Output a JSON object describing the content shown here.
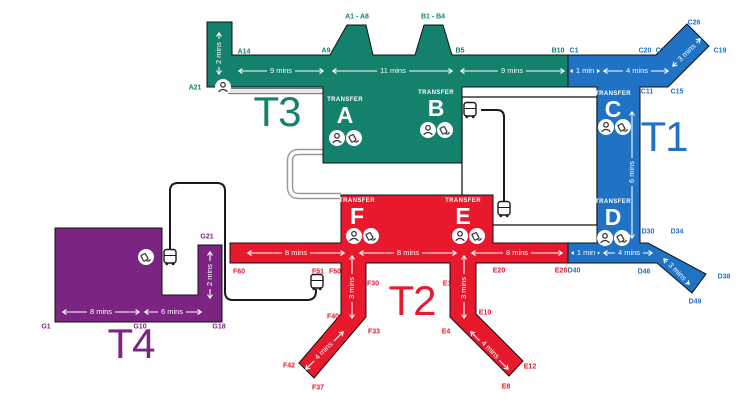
{
  "map_title": "Airport inter-terminal transfer map",
  "terminals": {
    "t1": {
      "label": "T1",
      "color": "#1F72C4"
    },
    "t2": {
      "label": "T2",
      "color": "#E8192C"
    },
    "t3": {
      "label": "T3",
      "color": "#14816C"
    },
    "t4": {
      "label": "T4",
      "color": "#7C2482"
    }
  },
  "transfer_label": "TRANSFER",
  "transfer_points": {
    "a": "A",
    "b": "B",
    "c": "C",
    "d": "D",
    "e": "E",
    "f": "F"
  },
  "gates": {
    "a21": "A21",
    "a14": "A14",
    "a9": "A9",
    "a1_a8": "A1 - A8",
    "b1_b4": "B1 - B4",
    "b5": "B5",
    "b10": "B10",
    "c1": "C1",
    "c20": "C20",
    "c23": "C23",
    "c26": "C26",
    "c19": "C19",
    "c11": "C11",
    "c15": "C15",
    "d30": "D30",
    "d34": "D34",
    "d40": "D40",
    "d46": "D46",
    "d38": "D38",
    "d49": "D49",
    "e28": "E28",
    "e20": "E20",
    "e1": "E1",
    "e4": "E4",
    "e10": "E10",
    "e12": "E12",
    "e8": "E8",
    "f30": "F30",
    "f33": "F33",
    "f40": "F40",
    "f42": "F42",
    "f37": "F37",
    "f50": "F50",
    "f51": "F51",
    "f60": "F60",
    "g1": "G1",
    "g10": "G10",
    "g18": "G18",
    "g21": "G21"
  },
  "walk_times": {
    "t3_col": "2 mins",
    "t3_seg1": "9 mins",
    "t3_seg2": "11 mins",
    "t3_seg3": "9 mins",
    "t1_top1": "1 min",
    "t1_top2": "4 mins",
    "t1_top_diag": "3 mins",
    "t1_col": "6 mins",
    "t1_bot1": "1 min",
    "t1_bot2": "4 mins",
    "t1_bot_diag": "3 mins",
    "t2_seg1": "8 mins",
    "t2_seg2": "8 mins",
    "t2_seg3": "8 mins",
    "t2_col_f": "3 mins",
    "t2_col_e": "3 mins",
    "t2_leg_f": "4 mins",
    "t2_leg_e": "4 mins",
    "t4_seg1": "8 mins",
    "t4_seg2": "6 mins",
    "t4_col": "2 mins"
  },
  "icons": {
    "bus": "bus-icon",
    "passport_control": "passport-control-icon",
    "transfer_desk": "transfer-desk-icon"
  }
}
